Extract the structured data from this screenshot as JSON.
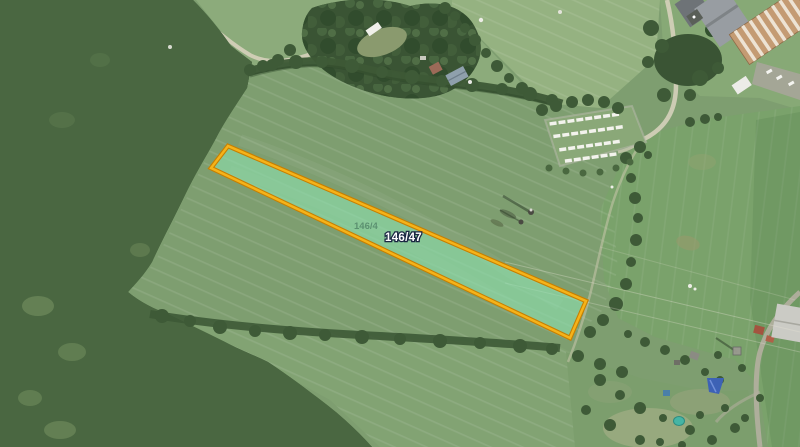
{
  "map": {
    "parcel": {
      "label": "146/47",
      "neighbor_label": "146/4"
    }
  },
  "palette": {
    "field_main": "#7E9E70",
    "field_top1": "#8CAB7B",
    "field_top2": "#95B281",
    "field_top3": "#87A976",
    "field_right": "#7AA26B",
    "field_bottom": "#82A373",
    "field_bl": "#88A577",
    "gardens": "#7C9E6D",
    "forest": "#4A6741",
    "forest_dark": "#3A5434",
    "tree": "#3E5A37",
    "hedge": "#3D5936",
    "road": "#D6D0BB",
    "track": "#CFC9B2",
    "parcel_stroke": "#F5B31A",
    "parcel_stroke_dark": "#C77F00",
    "parcel_fill": "rgba(140,225,175,0.62)",
    "label_color": "#FFFFFF",
    "label_outline": "#1A2742",
    "faint_label": "#2E5A49",
    "caravan_white": "#F3F3ED",
    "roof_tan": "#C49B73",
    "roof_stripe": "#EDE3D4",
    "roof_gray": "#989DA2",
    "pool_teal": "#45B5A5",
    "tarp_blue": "#3D62B5"
  }
}
